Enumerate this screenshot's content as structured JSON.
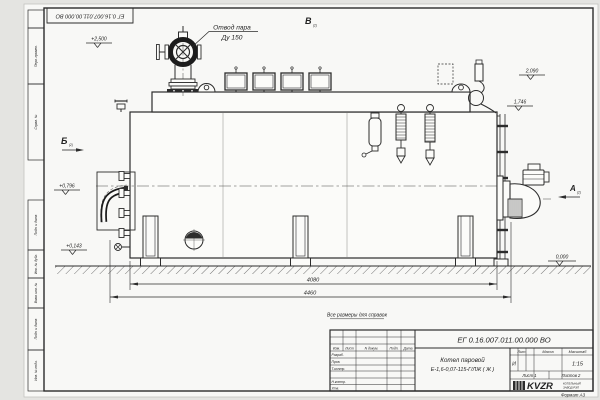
{
  "title_block": {
    "doc_number": "ЕГ 0.16.007.011.00.000 ВО",
    "name_line1": "Котел паровой",
    "name_line2": "Е-1,6-0,07-115-Г/ЛЖ ( Ж )",
    "col_headers": [
      "Изм.",
      "Лист",
      "N докум.",
      "Подп.",
      "Дата"
    ],
    "row_labels": [
      "Разраб.",
      "Пров.",
      "Т.контр.",
      "Н.контр.",
      "Утв."
    ],
    "lit_header": "Лит.",
    "mass_header": "Масса",
    "scale_header": "Масштаб",
    "lit_value": "И",
    "scale_value": "1:15",
    "sheet_info": "Лист 1",
    "sheets_info": "Листов 2",
    "logo": "KVZR",
    "logo_caption1": "КОТЕЛЬНЫЙ",
    "logo_caption2": "ЗАВОД РЭП",
    "format_note": "Формат А3"
  },
  "frame": {
    "side_labels": [
      "Перв. примен.",
      "Справ. №",
      "Подп. и дата",
      "Инв. № дубл.",
      "Взам. инв. №",
      "Подп. и дата",
      "Инв. № подл."
    ]
  },
  "callout": {
    "line1": "Отвод пара",
    "line2": "Ду 150"
  },
  "views": {
    "b": "Б",
    "v": "В",
    "a": "А",
    "sheet_ref": "(2)"
  },
  "elevations": {
    "steam_outlet": "+2,500",
    "right_upper": "2,090",
    "right_lower": "1,746",
    "left_upper": "+0,796",
    "left_lower": "+0,143",
    "ground": "0,000"
  },
  "dimensions": {
    "support_span": "4080",
    "overall_length": "4460"
  },
  "note": "Все размеры для справок"
}
